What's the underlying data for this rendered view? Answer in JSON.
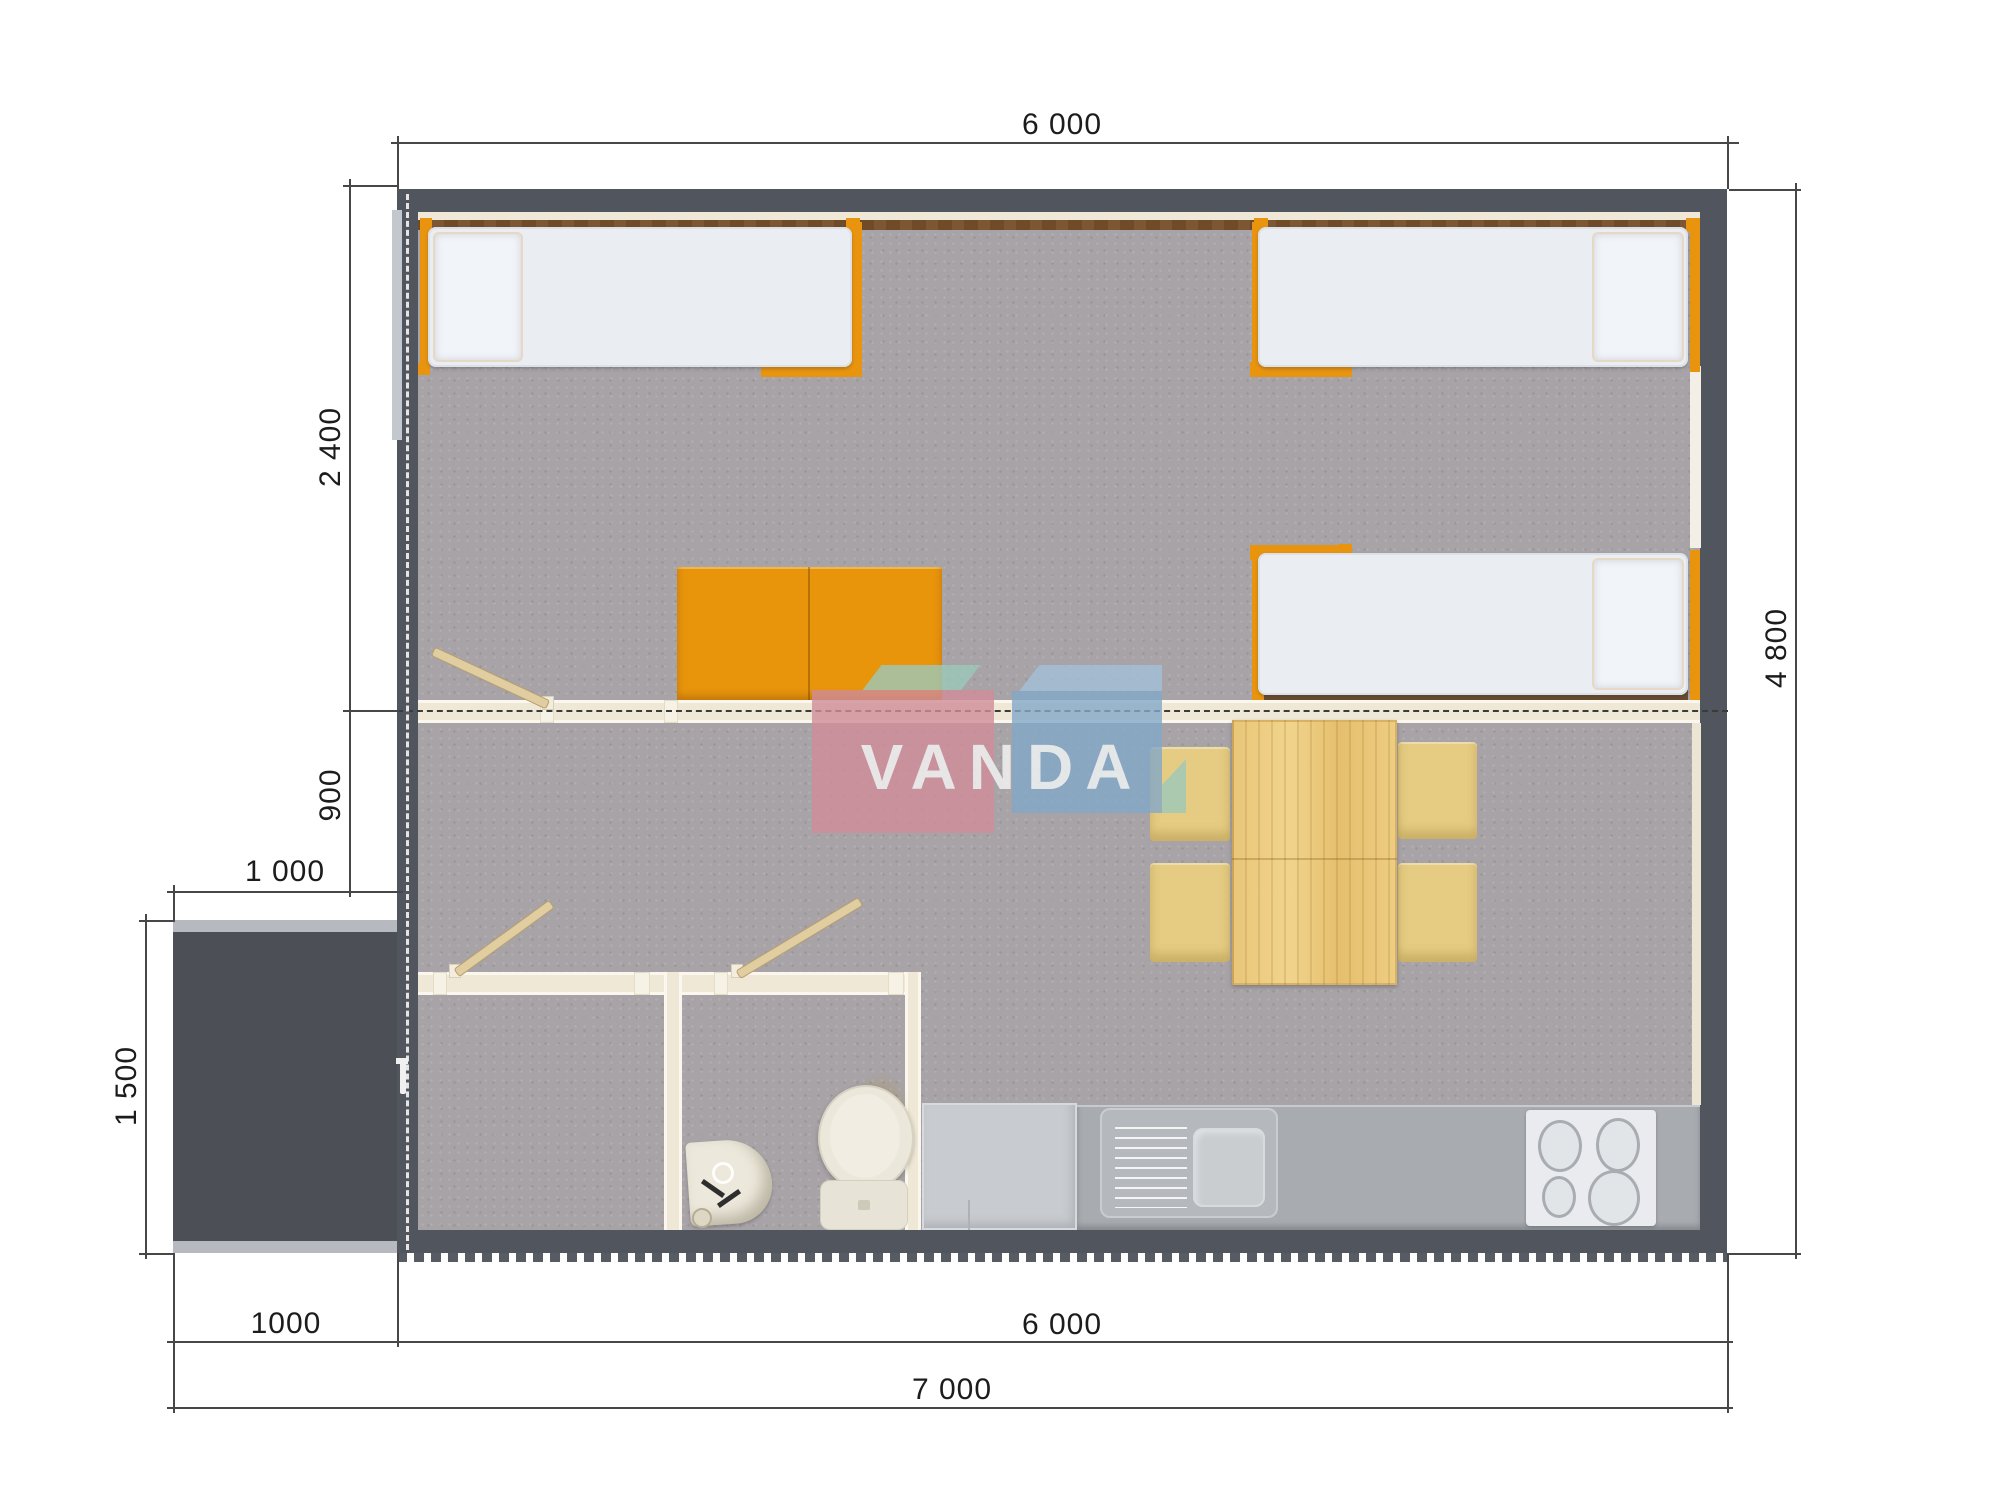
{
  "watermark": {
    "text": "VANDA",
    "pink": "#d18d99",
    "blue_front": "#84a9ca",
    "blue_top": "#a3c0da",
    "teal": "#9cc9bb",
    "text_color": "rgba(250,252,251,0.95)"
  },
  "dimensions": {
    "house_width_top": "6 000",
    "bedroom_depth": "2 400",
    "hall_depth": "900",
    "porch_width_top": "1 000",
    "porch_depth": "1 500",
    "house_depth": "4 800",
    "porch_width_bottom": "1000",
    "house_width_bottom": "6 000",
    "total_width": "7 000"
  },
  "colors": {
    "exterior_wall": "#51555d",
    "porch": "#4c5056",
    "carpet": "#a7a3a6",
    "interior_wall_cream": "#efe8d6",
    "accent_orange": "#e8940f",
    "wood_table": "#ecca7c",
    "kitchen_counter": "#a8acb1",
    "mattress": "#eaedf2",
    "dimension_line": "#474747"
  }
}
